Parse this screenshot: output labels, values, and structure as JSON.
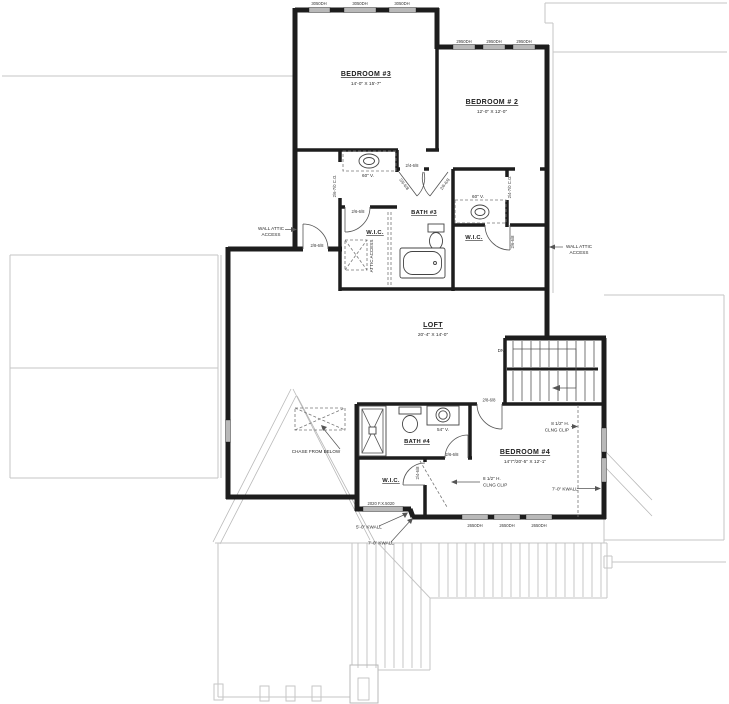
{
  "plan": {
    "rooms": {
      "bedroom3": {
        "name": "BEDROOM #3",
        "dims": "14'-0\" X 15'-7\""
      },
      "bedroom2": {
        "name": "BEDROOM # 2",
        "dims": "12'-0\" X 12'-0\""
      },
      "bath3": {
        "name": "BATH #3"
      },
      "wic_left": {
        "name": "W.I.C."
      },
      "wic_right": {
        "name": "W.I.C."
      },
      "loft": {
        "name": "LOFT",
        "dims": "20'-4\" X 14'-0\""
      },
      "bath4": {
        "name": "BATH #4"
      },
      "wic4": {
        "name": "W.I.C."
      },
      "bedroom4": {
        "name": "BEDROOM #4",
        "dims": "14'7\"/20'-5\" X 12'-1\""
      }
    },
    "fixtures": {
      "vanity3_left": "60\" V.",
      "vanity3_right": "60\" V.",
      "vanity4": "54\" V."
    },
    "doors": {
      "hall_loft": "2/8-6/8",
      "wic_left": "2/6-6/8",
      "bath3_entry": "2/4-6/8",
      "bath3_angled_left": "2/6-6/8",
      "bath3_angled_right": "2/6-6/8",
      "co_left": "2/6-7/0 C.O.",
      "co_right": "2/4-7/0 C.O.",
      "wic_right": "2/6-6/8",
      "bedroom4_entry": "2/8-6/8",
      "bath4": "2/6-6/8",
      "wic4": "2/4-6/8"
    },
    "windows": {
      "bedroom3": [
        "3050DH",
        "3050DH",
        "3050DH"
      ],
      "bedroom2": [
        "2950DH",
        "2950DH",
        "2950DH"
      ],
      "bedroom4": [
        "2650DH",
        "2650DH",
        "2650DH"
      ],
      "wic4_fixed": "2020 F.X.5020"
    },
    "notes": {
      "wall_attic_l1": "WALL ATTIC",
      "wall_attic_l2": "ACCESS",
      "wall_attic_r1": "WALL ATTIC",
      "wall_attic_r2": "ACCESS",
      "attic_access": "ATTIC ACCESS",
      "chase": "CHASE FROM BELOW",
      "dn": "DN",
      "clip_r1": "8 1/2\" H.",
      "clip_r2": "CLNG CLIP",
      "clip_l1": "8 1/2\" H.",
      "clip_l2": "CLNG CLIP",
      "kwall_right": "7'-0\" KWALL",
      "kwall_5": "5'-0\" KWALL",
      "kwall_7": "7'-0\" KWALL"
    }
  }
}
